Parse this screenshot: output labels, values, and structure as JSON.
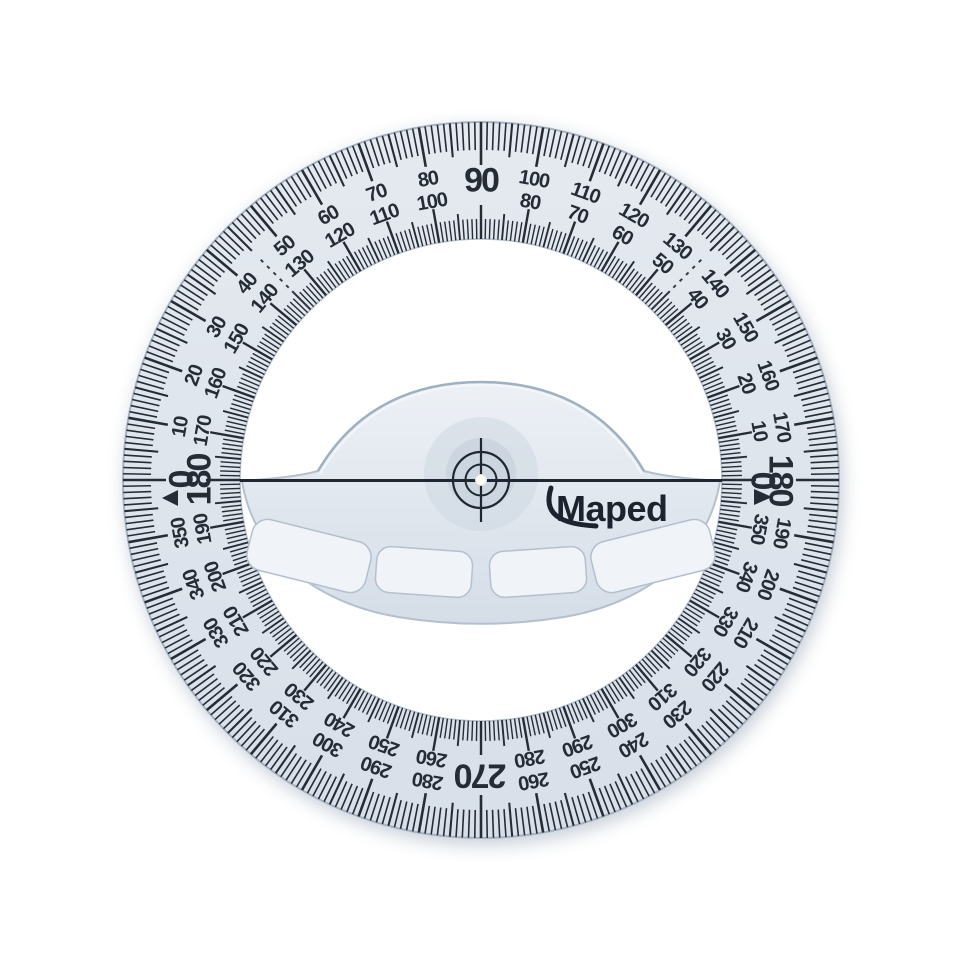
{
  "background_color": "#ffffff",
  "brand": {
    "name": "Maped",
    "color": "#1c232e"
  },
  "protractor": {
    "kind": "360-degree circular protractor",
    "body_color": "#dfe5ec",
    "ink_color": "#262c36",
    "handle_color": "#e3e9f0",
    "recess_color": "#f0f3f7",
    "tick_interval_deg": 1,
    "mid_tick_interval_deg": 5,
    "numbered_interval_deg": 10,
    "outer_scale": {
      "direction": "clockwise_from_west",
      "labels": [
        0,
        10,
        20,
        30,
        40,
        50,
        60,
        70,
        80,
        90,
        100,
        110,
        120,
        130,
        140,
        150,
        160,
        170,
        180,
        190,
        200,
        210,
        220,
        230,
        240,
        250,
        260,
        270,
        280,
        290,
        300,
        310,
        320,
        330,
        340,
        350
      ],
      "big_labels": [
        0,
        90,
        180,
        270
      ],
      "omitted_labels": [],
      "zero_marker": "filled-triangle-pointing-west"
    },
    "inner_scale": {
      "direction": "counterclockwise_from_east",
      "labels": [
        0,
        10,
        20,
        30,
        40,
        50,
        60,
        70,
        80,
        100,
        110,
        120,
        130,
        140,
        150,
        160,
        170,
        180,
        190,
        200,
        210,
        220,
        230,
        240,
        250,
        260,
        280,
        290,
        300,
        310,
        320,
        330,
        340,
        350
      ],
      "big_labels": [
        0,
        180
      ],
      "omitted_labels": [
        90,
        270
      ],
      "zero_marker": "filled-triangle-pointing-east"
    },
    "guide_marks_deg": [
      45,
      135
    ],
    "center_features": [
      "crosshair-target",
      "white-center-dot",
      "horizontal-zero-line",
      "dome-handle",
      "four-grip-recesses"
    ]
  }
}
